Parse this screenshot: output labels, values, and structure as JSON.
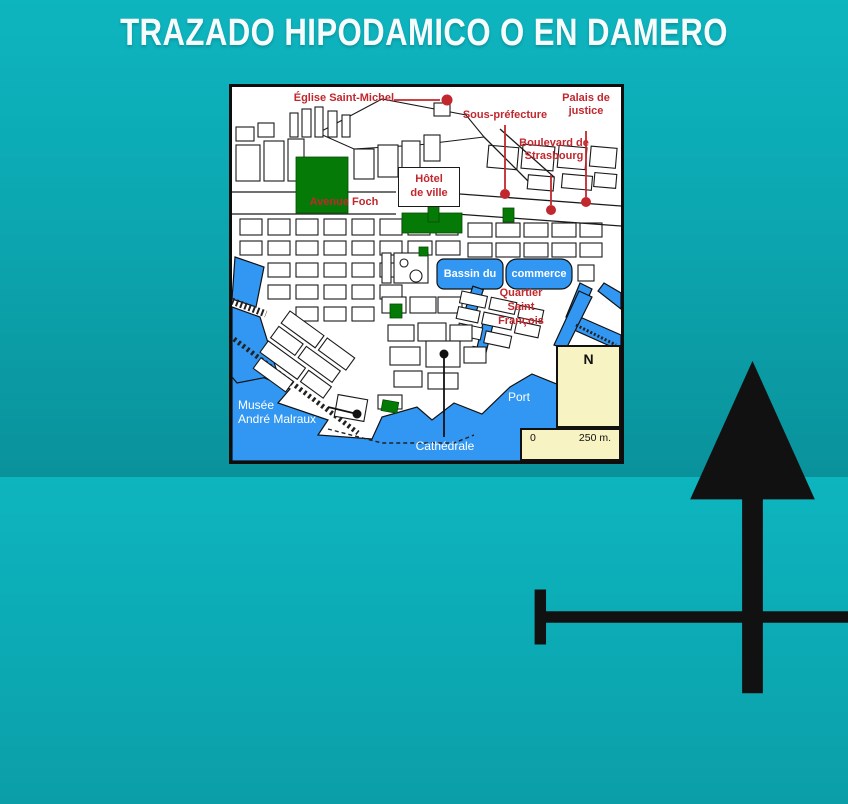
{
  "slide": {
    "title": "TRAZADO HIPODAMICO O EN DAMERO"
  },
  "colors": {
    "background_top": "#0db5bf",
    "background_bottom": "#0a929b",
    "title_text": "#ffffff",
    "map_background": "#ffffff",
    "map_border": "#0d0d0d",
    "water_blue": "#3297f2",
    "park_green": "#067a06",
    "label_red": "#c1272d",
    "label_white": "#ffffff",
    "legend_cream": "#f7f3c3",
    "marker_red": "#c1272d",
    "marker_black": "#111111"
  },
  "map": {
    "labels": {
      "eglise": "Église Saint-Michel",
      "sous_prefecture": "Sous-préfecture",
      "palais_1": "Palais de",
      "palais_2": "justice",
      "boulevard_1": "Boulevard de",
      "boulevard_2": "Strasbourg",
      "hotel_1": "Hôtel",
      "hotel_2": "de ville",
      "avenue_foch": "Avenue Foch",
      "bassin_1": "Bassin du",
      "bassin_2": "commerce",
      "quartier_1": "Quartier",
      "quartier_2": "Saint",
      "quartier_3": "François",
      "port": "Port",
      "musee_1": "Musée",
      "musee_2": "André Malraux",
      "cathedrale": "Cathédrale"
    },
    "legend": {
      "north": "N",
      "scale_start": "0",
      "scale_end": "250 m."
    }
  }
}
